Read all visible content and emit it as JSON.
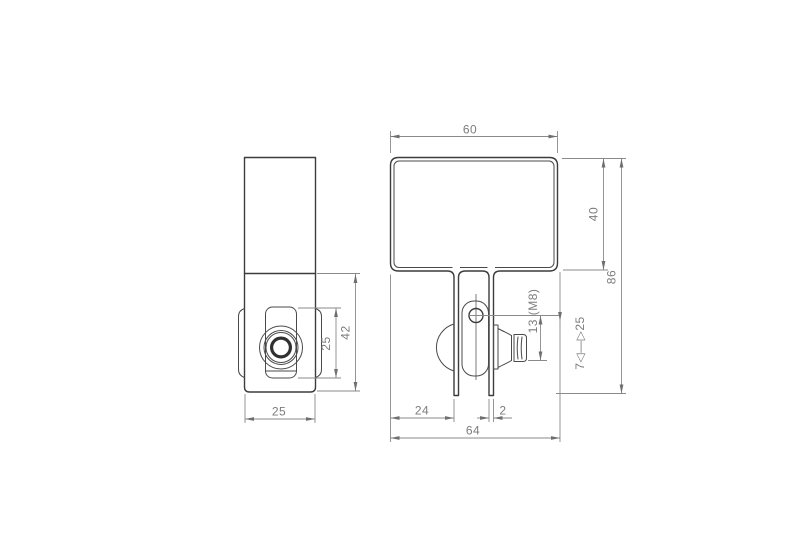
{
  "page": {
    "background": "#ffffff"
  },
  "colors": {
    "part_outline": "#3c3c3c",
    "part_detail": "#4a4a4a",
    "dimension_lines": "#8a8a8a",
    "dimension_text": "#7c7c7c"
  },
  "views": {
    "side": {
      "dim_depth": "25",
      "dim_pivot_height": "25",
      "dim_lower_height": "42"
    },
    "front": {
      "dim_width": "60",
      "dim_upper_height": "40",
      "dim_total_height": "86",
      "dim_leg_offset": "24",
      "dim_leg_thickness": "2",
      "dim_overall_width": "64",
      "dim_hole_thread": "13 (M8)",
      "dim_adjust_range": "7◁—▷25"
    }
  }
}
